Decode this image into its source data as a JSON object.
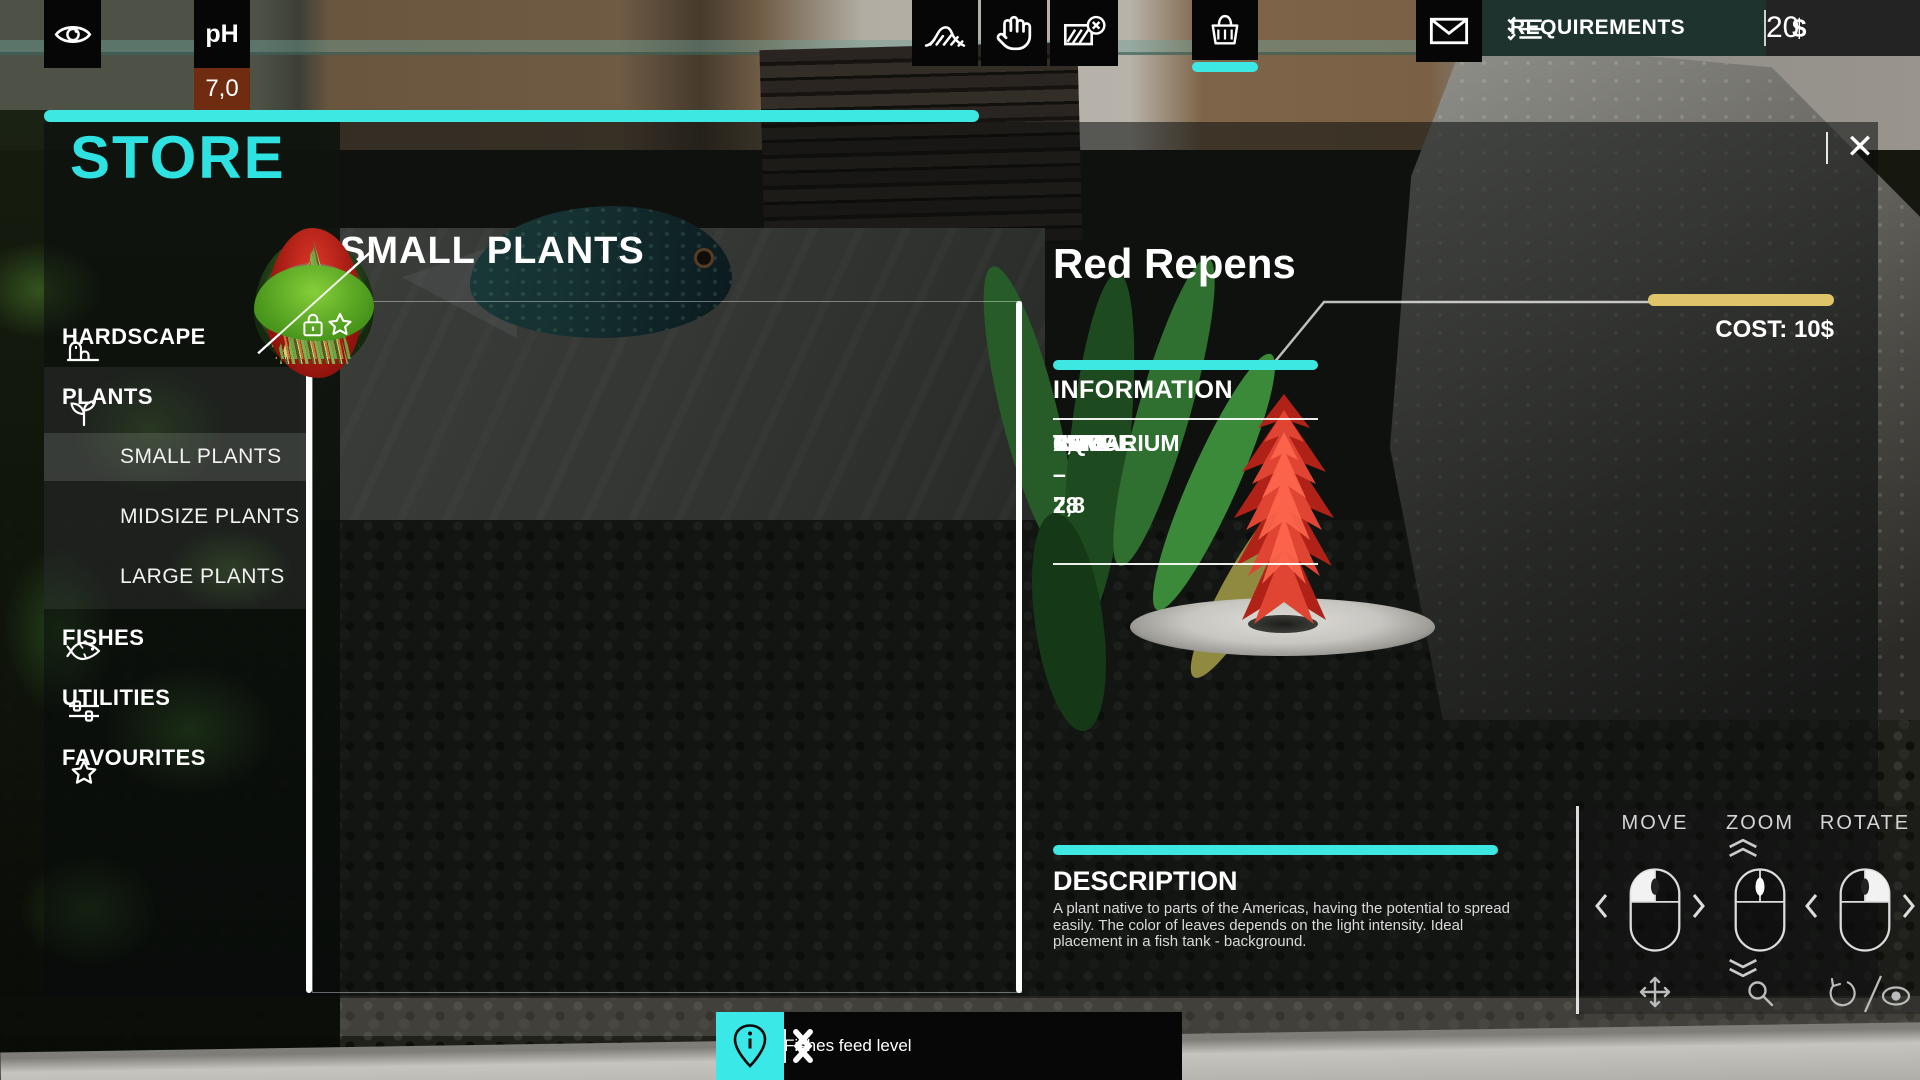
{
  "hud": {
    "ph": {
      "label": "pH",
      "value": "7,0"
    },
    "requirements_label": "REQUIREMENTS",
    "currency_symbol": "$",
    "money": "20"
  },
  "store": {
    "title": "STORE",
    "close_label": "✕",
    "section_title": "SMALL PLANTS",
    "sidebar": [
      {
        "label": "HARDSCAPE",
        "icon": "rock-icon",
        "type": "category"
      },
      {
        "label": "PLANTS",
        "icon": "sprout-icon",
        "type": "category",
        "active": true
      },
      {
        "label": "SMALL PLANTS",
        "type": "subcategory",
        "selected": true
      },
      {
        "label": "MIDSIZE PLANTS",
        "type": "subcategory"
      },
      {
        "label": "LARGE PLANTS",
        "type": "subcategory"
      },
      {
        "label": "FISHES",
        "icon": "fish-icon",
        "type": "category"
      },
      {
        "label": "UTILITIES",
        "icon": "sliders-icon",
        "type": "category"
      },
      {
        "label": "FAVOURITES",
        "icon": "star-icon",
        "type": "category"
      }
    ],
    "grid": {
      "rows": 4,
      "cols": 4,
      "cells": [
        {
          "favorite_star": true,
          "locked": false,
          "unavailable": false,
          "selected": false,
          "plant": {
            "shape": "bush",
            "w": 120,
            "h": 130,
            "c1": "#3f7a2b",
            "c2": "#16290f"
          }
        },
        {
          "favorite_star": true,
          "locked": false,
          "unavailable": false,
          "selected": false,
          "plant": {
            "shape": "tuft",
            "w": 52,
            "h": 120,
            "c1": "#7fae57",
            "c2": "#44632c"
          }
        },
        {
          "favorite_star": true,
          "locked": true,
          "unavailable": true,
          "selected": false,
          "plant": {
            "shape": "tuft",
            "w": 110,
            "h": 88,
            "c1": "#6fa344",
            "c2": "#2e4f1d"
          }
        },
        {
          "favorite_star": true,
          "locked": false,
          "unavailable": false,
          "selected": false,
          "plant": {
            "shape": "bush",
            "w": 92,
            "h": 62,
            "c1": "#4e8232",
            "c2": "#1e3a14"
          }
        },
        {
          "favorite_star": true,
          "locked": false,
          "unavailable": false,
          "selected": false,
          "plant": {
            "shape": "bush",
            "w": 112,
            "h": 100,
            "c1": "#51703a",
            "c2": "#2c4020"
          }
        },
        {
          "favorite_star": true,
          "locked": false,
          "unavailable": false,
          "selected": false,
          "plant": {
            "shape": "tuft",
            "w": 72,
            "h": 112,
            "c1": "#a8c46a",
            "c2": "#5e7a37"
          }
        },
        {
          "favorite_star": true,
          "locked": true,
          "unavailable": true,
          "selected": false,
          "plant": {
            "shape": "bush",
            "w": 74,
            "h": 98,
            "c1": "#8fc35e",
            "c2": "#4a7a2e"
          }
        },
        {
          "favorite_star": true,
          "locked": false,
          "unavailable": false,
          "selected": false,
          "plant": {
            "shape": "bush",
            "w": 58,
            "h": 112,
            "c1": "#aacb55",
            "c2": "#5e8a2a"
          }
        },
        {
          "favorite_star": true,
          "locked": false,
          "unavailable": false,
          "selected": false,
          "plant": {
            "shape": "bush",
            "w": 52,
            "h": 92,
            "c1": "#7a8a4a",
            "c2": "#6b3a2e"
          }
        },
        {
          "favorite_star": true,
          "locked": true,
          "unavailable": true,
          "selected": true,
          "plant": {
            "shape": "bush",
            "w": 96,
            "h": 150,
            "c1": "#e5392a",
            "c2": "#8f130c"
          }
        },
        {
          "favorite_star": true,
          "locked": true,
          "unavailable": true,
          "selected": false,
          "plant": {
            "shape": "bush",
            "w": 104,
            "h": 80,
            "c1": "#c08272",
            "c2": "#7a4538"
          }
        },
        {
          "favorite_star": true,
          "locked": true,
          "unavailable": true,
          "selected": false,
          "plant": {
            "shape": "tuft",
            "w": 92,
            "h": 112,
            "c1": "#69a844",
            "c2": "#c27a35"
          }
        },
        {
          "favorite_star": true,
          "locked": true,
          "unavailable": true,
          "selected": false,
          "plant": {
            "shape": "tuft",
            "w": 82,
            "h": 122,
            "c1": "#cfd27a",
            "c2": "#8a9a4a"
          }
        },
        {
          "favorite_star": true,
          "locked": true,
          "unavailable": true,
          "selected": false,
          "plant": {
            "shape": "tuft",
            "w": 70,
            "h": 122,
            "c1": "#7cb24e",
            "c2": "#3f6a26"
          }
        },
        {
          "favorite_star": true,
          "locked": true,
          "unavailable": true,
          "selected": false,
          "plant": {
            "shape": "bush",
            "w": 120,
            "h": 76,
            "c1": "#86ce3a",
            "c2": "#47951b"
          }
        },
        {
          "empty": true
        }
      ]
    },
    "detail": {
      "name": "Red Repens",
      "cost_label": "COST: 10$",
      "information_title": "INFORMATION",
      "stats": [
        {
          "label": "SIZE",
          "value": "LARGE"
        },
        {
          "label": "PH",
          "value": "6,4 – 7,8"
        },
        {
          "label": "TEMP.",
          "value": "15 – 28"
        },
        {
          "label": "AQUARIUM",
          "value": "LARGE"
        }
      ],
      "description_title": "DESCRIPTION",
      "description": "A plant native to parts of the Americas, having the potential to spread easily. The color of leaves depends on the light intensity. Ideal placement in a fish tank - background."
    },
    "controls": [
      {
        "label": "MOVE"
      },
      {
        "label": "ZOOM"
      },
      {
        "label": "ROTATE"
      }
    ]
  },
  "bottom_bar": {
    "tooltip": "Fishes feed level"
  },
  "colors": {
    "accent_cyan": "#3ee8e2",
    "store_title_cyan": "#2fe2e2",
    "gold": "#dfc469",
    "hud_teal": "#1e322e",
    "ph_badge": "#702c10",
    "selected_cell_overlay": "rgba(255,255,255,0.30)"
  }
}
